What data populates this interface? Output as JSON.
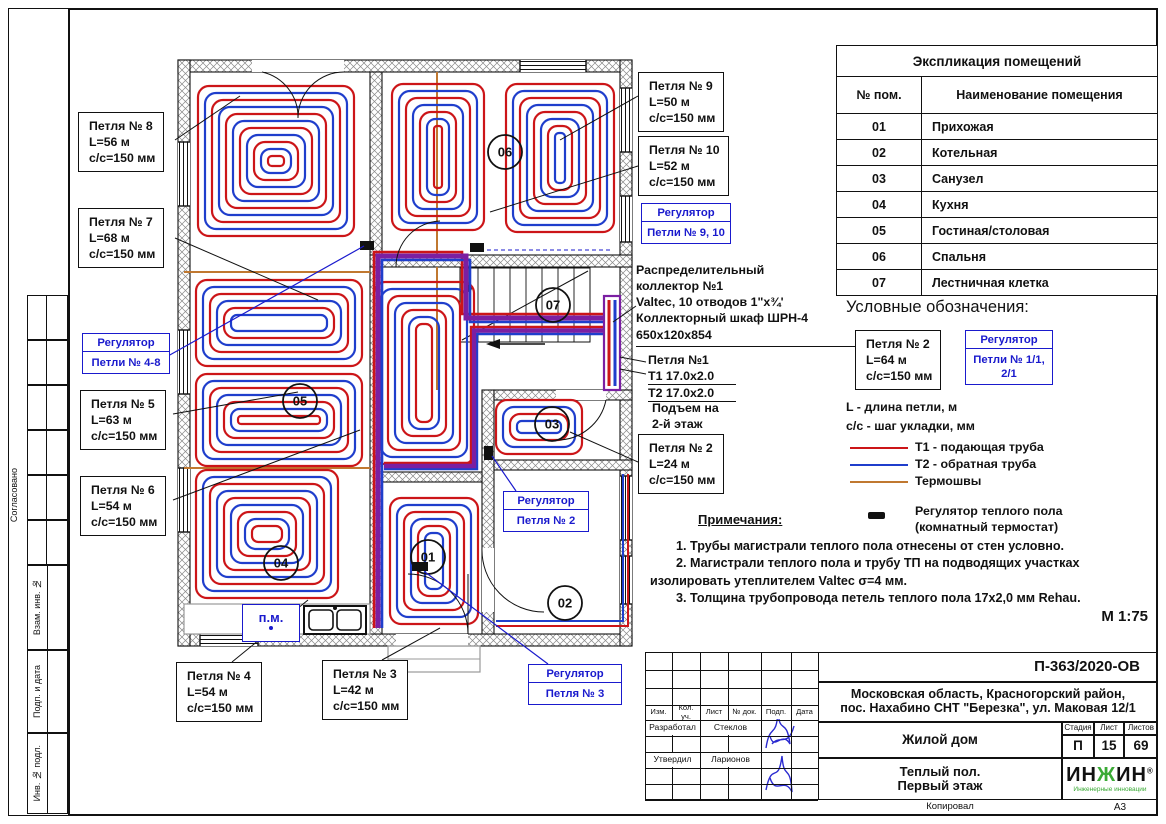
{
  "colors": {
    "t1_red": "#cc1518",
    "t2_blue": "#1f3ecc",
    "joint_brown": "#c07830",
    "trunk_purple": "#7b1fa2",
    "blue_accent": "#1a1acd",
    "logo_green": "#3aaa35"
  },
  "room_table": {
    "title": "Экспликация помещений",
    "col1": "№ пом.",
    "col2": "Наименование помещения",
    "rows": [
      [
        "01",
        "Прихожая"
      ],
      [
        "02",
        "Котельная"
      ],
      [
        "03",
        "Санузел"
      ],
      [
        "04",
        "Кухня"
      ],
      [
        "05",
        "Гостиная/столовая"
      ],
      [
        "06",
        "Спальня"
      ],
      [
        "07",
        "Лестничная клетка"
      ]
    ]
  },
  "legend": {
    "title": "Условные обозначения:",
    "sample_loop": [
      "Петля № 2",
      "L=64 м",
      "с/с=150 мм"
    ],
    "sample_regulator": {
      "head": "Регулятор",
      "body": [
        "Петли № 1/1,",
        "2/1"
      ]
    },
    "defs": [
      "L - длина петли, м",
      "с/с - шаг укладки, мм"
    ],
    "lines": [
      {
        "label": "Т1 - подающая труба",
        "color": "#cc1518"
      },
      {
        "label": "Т2 - обратная труба",
        "color": "#1f3ecc"
      },
      {
        "label": "Термошвы",
        "color": "#c07830"
      },
      {
        "label": "Регулятор теплого пола (комнатный термостат)",
        "chip": true
      }
    ]
  },
  "notes": {
    "title": "Примечания:",
    "items": [
      "1.    Трубы магистрали теплого пола отнесены от стен условно.",
      "2.    Магистрали теплого пола и трубу ТП на подводящих участках изолировать утеплителем Valtec σ=4 мм.",
      "3.    Толщина трубопровода петель теплого пола 17х2,0 мм Rehau."
    ]
  },
  "scale": "М 1:75",
  "collector_note": [
    "Распределительный",
    "коллектор №1",
    "Valtec, 10 отводов 1\"х¾'",
    "Коллекторный шкаф ШРН-4",
    "650х120х854"
  ],
  "loop1_note": {
    "title": "Петля №1",
    "t1": "Т1 17.0х2.0",
    "t2": "Т2 17.0х2.0",
    "riser": [
      "Подъем на",
      "2-й этаж"
    ]
  },
  "loop_callouts": [
    {
      "id": "8",
      "lines": [
        "Петля № 8",
        "L=56 м",
        "с/с=150 мм"
      ]
    },
    {
      "id": "7",
      "lines": [
        "Петля № 7",
        "L=68 м",
        "с/с=150 мм"
      ]
    },
    {
      "id": "5",
      "lines": [
        "Петля № 5",
        "L=63 м",
        "с/с=150 мм"
      ]
    },
    {
      "id": "6",
      "lines": [
        "Петля № 6",
        "L=54 м",
        "с/с=150 мм"
      ]
    },
    {
      "id": "4",
      "lines": [
        "Петля № 4",
        "L=54 м",
        "с/с=150 мм"
      ]
    },
    {
      "id": "3",
      "lines": [
        "Петля № 3",
        "L=42 м",
        "с/с=150 мм"
      ]
    },
    {
      "id": "9",
      "lines": [
        "Петля № 9",
        "L=50 м",
        "с/с=150 мм"
      ]
    },
    {
      "id": "10",
      "lines": [
        "Петля № 10",
        "L=52 м",
        "с/с=150 мм"
      ]
    },
    {
      "id": "2",
      "lines": [
        "Петля № 2",
        "L=24 м",
        "с/с=150 мм"
      ]
    }
  ],
  "regulator_callouts": [
    {
      "id": "4-8",
      "head": "Регулятор",
      "body": [
        "Петли № 4-8"
      ]
    },
    {
      "id": "9-10",
      "head": "Регулятор",
      "body": [
        "Петли № 9, 10"
      ]
    },
    {
      "id": "2",
      "head": "Регулятор",
      "body": [
        "Петля № 2"
      ]
    },
    {
      "id": "3",
      "head": "Регулятор",
      "body": [
        "Петля № 3"
      ]
    }
  ],
  "room_circles": [
    {
      "num": "01"
    },
    {
      "num": "02"
    },
    {
      "num": "03"
    },
    {
      "num": "04"
    },
    {
      "num": "05"
    },
    {
      "num": "06"
    },
    {
      "num": "07"
    }
  ],
  "misc": {
    "pm_label": "п.м."
  },
  "sidebar": [
    "Согласовано",
    "Взам. инв. №",
    "Подп. и дата",
    "Инв. № подл."
  ],
  "stamp": {
    "doc_number": "П-363/2020-ОВ",
    "address_line1": "Московская область, Красногорский район,",
    "address_line2": "пос. Нахабино СНТ \"Березка\", ул. Маковая 12/1",
    "object_name": "Жилой дом",
    "sheet_title_line1": "Теплый пол.",
    "sheet_title_line2": "Первый этаж",
    "stage_label": "Стадия",
    "sheet_label": "Лист",
    "sheets_label": "Листов",
    "stage": "П",
    "sheet": "15",
    "sheets": "69",
    "cols": [
      "Изм.",
      "Кол. уч.",
      "Лист",
      "№ док.",
      "Подп.",
      "Дата"
    ],
    "developed_label": "Разработал",
    "developed_by": "Стеклов",
    "approved_label": "Утвердил",
    "approved_by": "Ларионов",
    "copied_label": "Копировал",
    "format": "А3",
    "logo_text_1": "ИН",
    "logo_text_g": "Ж",
    "logo_text_2": "ИН",
    "logo_reg": "®",
    "logo_sub": "Инженерные инновации"
  }
}
